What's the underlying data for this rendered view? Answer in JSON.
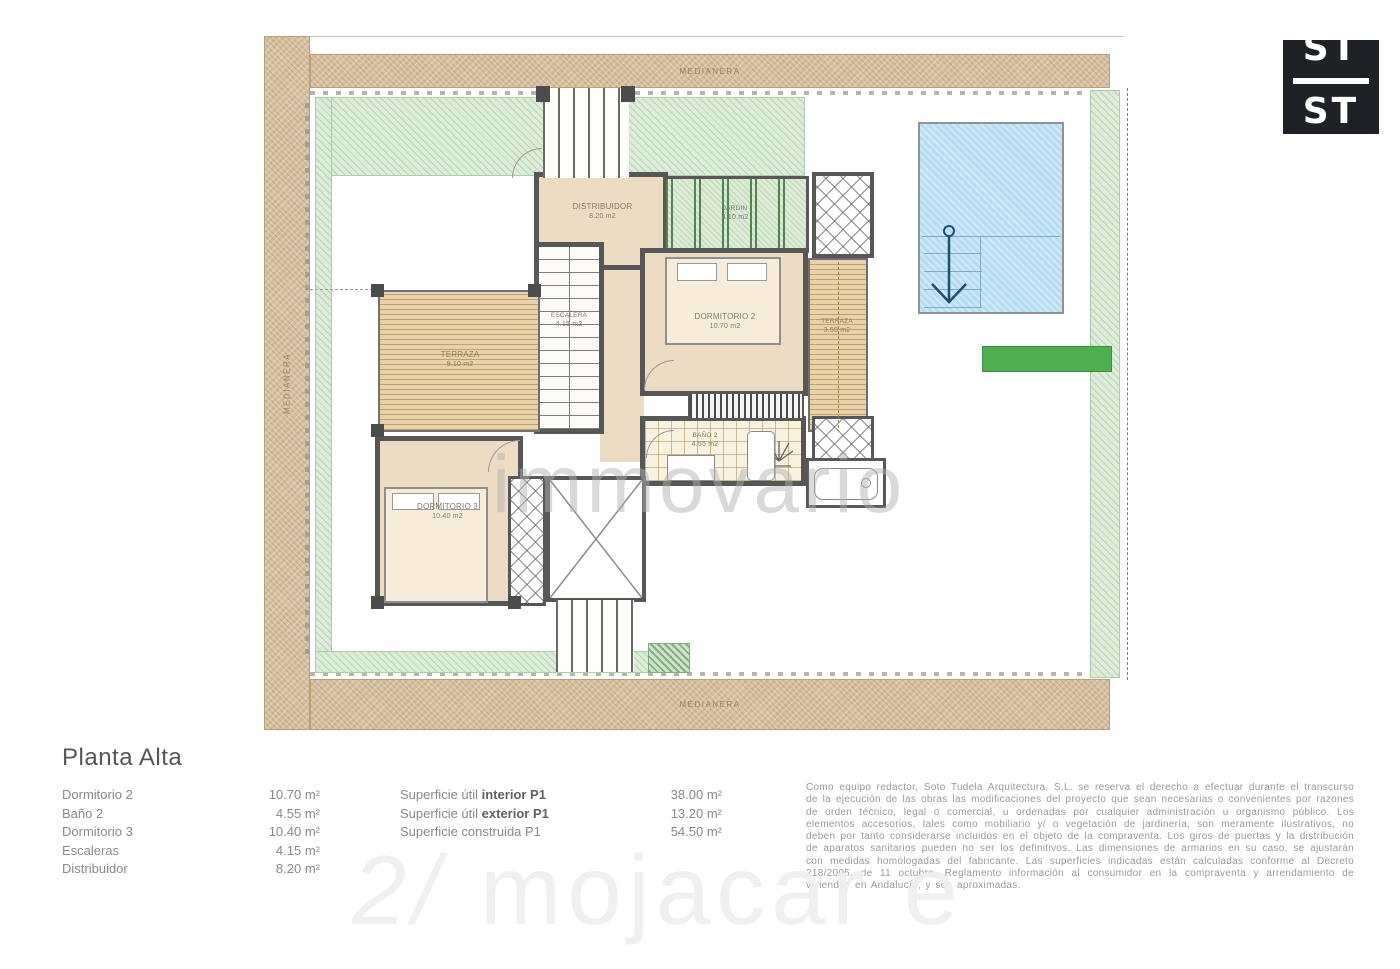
{
  "logo": {
    "line1": "ST",
    "line2": "ST"
  },
  "plan": {
    "medianera": "MEDIANERA",
    "rooms": [
      {
        "label": "DISTRIBUIDOR",
        "area": "8.20 m2"
      },
      {
        "label": "JARDIN",
        "area": "4.10 m2"
      },
      {
        "label": "DORMITORIO 2",
        "area": "10.70 m2"
      },
      {
        "label": "TERRAZA",
        "area": "3.50 m2"
      },
      {
        "label": "ESCALERA",
        "area": "4.15 m2"
      },
      {
        "label": "TERRAZA",
        "area": "9.10 m2"
      },
      {
        "label": "BAÑO 2",
        "area": "4.55 m2"
      },
      {
        "label": "DORMITORIO 3",
        "area": "10.40 m2"
      }
    ]
  },
  "watermarks": {
    "center": "immovario",
    "bottom_icon": "2/",
    "bottom_text": "mojacar e"
  },
  "legend": {
    "title": "Planta Alta",
    "rooms": [
      {
        "name": "Dormitorio 2",
        "area": "10.70 m²"
      },
      {
        "name": "Baño 2",
        "area": "4.55 m²"
      },
      {
        "name": "Dormitorio 3",
        "area": "10.40 m²"
      },
      {
        "name": "Escaleras",
        "area": "4.15 m²"
      },
      {
        "name": "Distribuidor",
        "area": "8.20 m²"
      }
    ],
    "surfaces": [
      {
        "label": "Superficie útil ",
        "bold": "interior P1",
        "value": "38.00 m²"
      },
      {
        "label": "Superficie útil ",
        "bold": "exterior P1",
        "value": "13.20 m²"
      },
      {
        "label": "Superficie construida P1",
        "bold": "",
        "value": "54.50 m²"
      }
    ],
    "disclaimer": "Como equipo redactor, Soto Tudela Arquitectura, S.L. se reserva el derecho a efectuar durante el transcurso de la ejecución de las obras las modificaciones del proyecto que sean necesarias o convenientes por razones de orden técnico, legal o comercial, u ordenadas por cualquier administración u organismo público. Los elementos accesorios, tales como mobiliario y/ o vegetación de jardinería, son meramente ilustrativos, no deben por tanto considerarse incluidos en el objeto de la compraventa. Los giros de puertas y la distribución de aparatos sanitarios pueden no ser los definitivos. Las dimensiones de armarios en su caso, se ajustarán con medidas homologadas del fabricante. Las superficies indicadas están calculadas conforme al Decreto 218/2005, de 11 octubre. Reglamento información al consumidor en la compraventa y arrendamiento de viviendas en Andalucía, y son aproximadas."
  },
  "colors": {
    "wall": "#575757",
    "floor": "#ecdcc3",
    "sand_band": "#d7bf9d",
    "garden": "#ddecd8",
    "grass_bar": "#4fae4f",
    "pool": "#b6ddf3",
    "text_gray": "#87898c"
  }
}
